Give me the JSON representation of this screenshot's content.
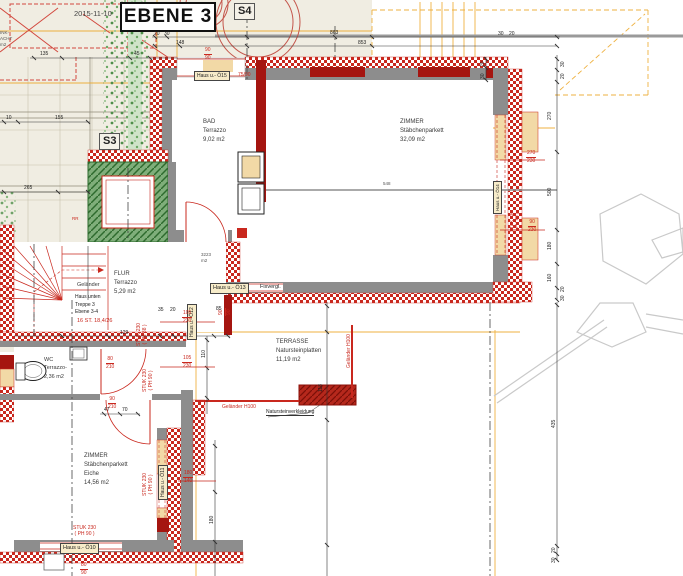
{
  "header": {
    "date": "2015-11-10",
    "title": "EBENE 3"
  },
  "markers": {
    "s3": "S3",
    "s4": "S4"
  },
  "rooms": {
    "bad": {
      "name": "BAD",
      "finish": "Terrazzo",
      "area": "9,02 m2"
    },
    "zimmer_gross": {
      "name": "ZIMMER",
      "finish": "Stäbchenparkett",
      "area": "32,09 m2"
    },
    "flur": {
      "name": "FLUR",
      "finish": "Terrazzo",
      "area": "5,29 m2"
    },
    "wc": {
      "name": "WC",
      "finish": "Terrazzo-",
      "area": "2,36 m2"
    },
    "zimmer_klein": {
      "name": "ZIMMER",
      "finish": "Stäbchenparkett",
      "material": "Eiche",
      "area": "14,56 m2"
    },
    "terrasse": {
      "name": "TERRASSE",
      "finish": "Natursteinplatten",
      "area": "11,19 m2"
    }
  },
  "stairs": {
    "railing": "Geländer",
    "loc1": "Haus unten",
    "loc2": "Treppe 3",
    "loc3": "Ebene 3-4",
    "count": "16 ST.",
    "going": "18,4/26"
  },
  "windows": {
    "o10": "Haus u.- Ö10",
    "o11": "Haus u.- Ö11",
    "o12": "Haus u.- Ö12",
    "o13": "Haus u.- Ö13",
    "o13b": "Fixvergl.",
    "o14": "Haus u.- Ö14",
    "o15": "Haus u.- Ö15"
  },
  "notes": {
    "stuk230": "STUK 230",
    "ph88": "( PH 88 )",
    "ph90": "( PH 90 )",
    "railing": "Geländer H100",
    "cladding": "Natursteinverkleidung",
    "area_small1": "3223",
    "area_small2": "m2"
  },
  "red_dims": {
    "door_wc": {
      "a": "80",
      "b": "210"
    },
    "door_zimmer": {
      "a": "90",
      "b": "210"
    },
    "win_flur1": {
      "a": "105",
      "b": "230"
    },
    "win_flur2": {
      "a": "105",
      "b": "230"
    },
    "win_zimmer": {
      "a": "180",
      "b": "140"
    },
    "win_right1": {
      "a": "270",
      "b": "230"
    },
    "win_right2": {
      "a": "90",
      "b": "230"
    },
    "win_top": "75/90",
    "top_pair": {
      "a": "90",
      "b": "90"
    },
    "side_pair": {
      "a": "90",
      "b": "90"
    },
    "bottom_pair": {
      "a": "80",
      "b": "90"
    }
  },
  "dims": {
    "t20": "20",
    "t30": "30",
    "t148": "148",
    "t863": "863",
    "t853": "853",
    "tr30": "30",
    "tr20": "20",
    "v20": "20",
    "v30": "30",
    "r30": "30",
    "r20": "20",
    "r270": "270",
    "r500": "500",
    "r180": "180",
    "r160": "160",
    "rb20": "20",
    "rb30": "30",
    "rl435": "435",
    "rl20": "20",
    "rl30": "30",
    "b129": "129",
    "b35": "35",
    "b20": "20",
    "b85": "85",
    "b110": "110",
    "b118": "118",
    "b47": "47",
    "b70": "70",
    "b180": "180",
    "l135": "135",
    "l45": "45",
    "l10": "10",
    "l155": "155",
    "l265": "265",
    "i548": "548"
  },
  "context": {
    "frag1": "INK-",
    "frag2": "ACHT",
    "frag3": "m2",
    "rr": "RR"
  }
}
